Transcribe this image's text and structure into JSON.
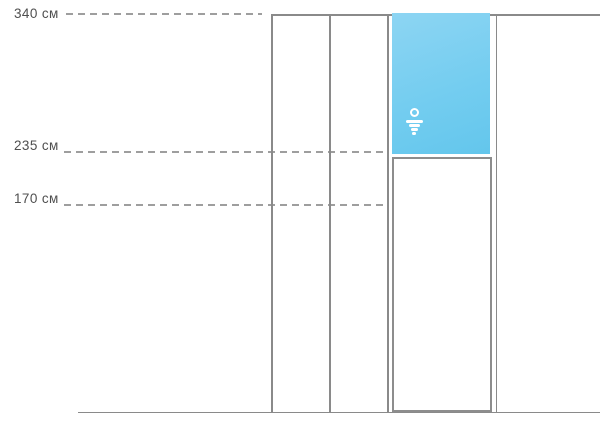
{
  "diagram": {
    "type": "elevation-height-diagram",
    "unit": "см",
    "height_marks": [
      {
        "label": "340 см",
        "value": 340
      },
      {
        "label": "235 см",
        "value": 235
      },
      {
        "label": "170 см",
        "value": 170
      }
    ],
    "panels": {
      "highlighted_zone": {
        "top_mark": 340,
        "bottom_mark": 235,
        "icon": "water-spray-logo-icon"
      },
      "lower_zone": {
        "top_mark": 235,
        "bottom_mark": 0
      }
    },
    "colors": {
      "wall_line": "#8a8a8a",
      "dash_line": "#9e9e9e",
      "label_text": "#4f4f4f",
      "panel_blue_top": "#8dd5f3",
      "panel_blue_bottom": "#63c6ec",
      "icon_white": "#ffffff"
    }
  }
}
